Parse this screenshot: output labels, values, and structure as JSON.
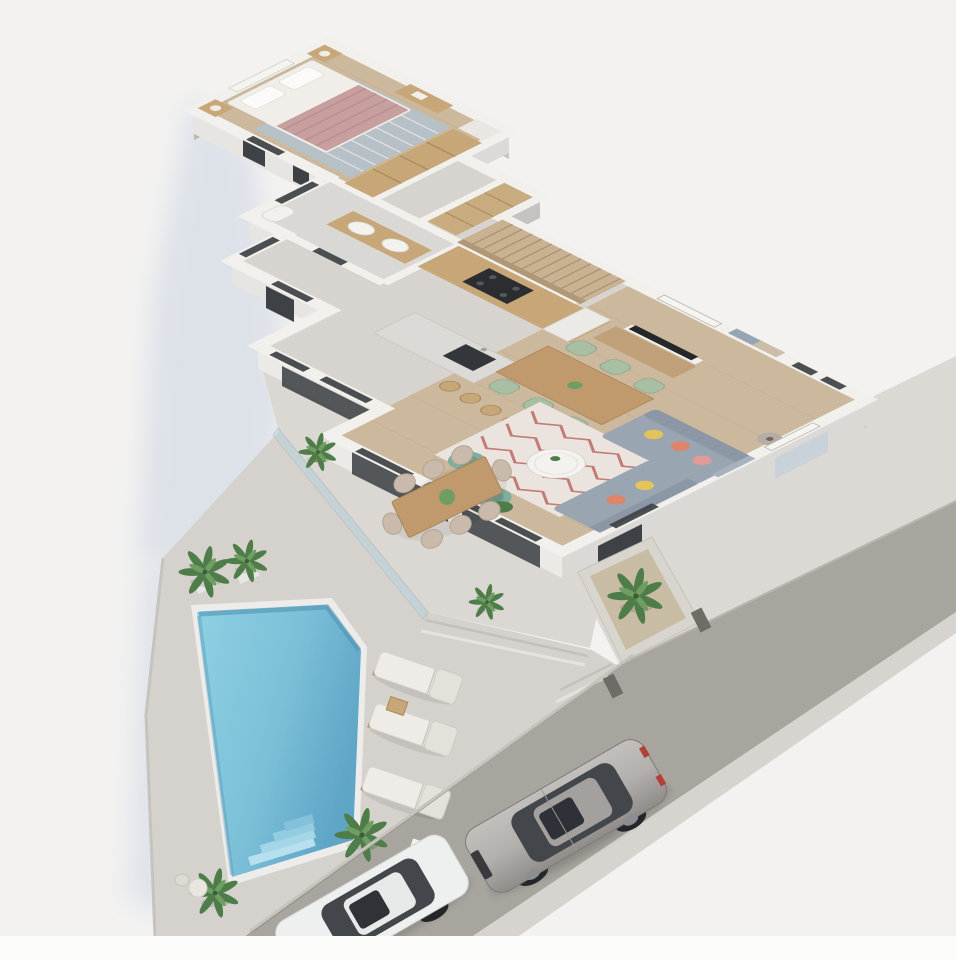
{
  "scene": {
    "description": "3D isometric cutaway render of a single-storey villa ground floor with pool terrace, outdoor dining, sun loungers and a street with two parked cars",
    "projection": "isometric 2:1 cutaway, walls cut at waist height",
    "no_visible_text": true
  },
  "house": {
    "rooms": [
      {
        "name": "bedroom",
        "floor": "wood",
        "furniture": [
          "double-bed",
          "pink-striped-blanket",
          "white-pillows",
          "nightstands-x2",
          "table-lamps",
          "blue-patterned-rug",
          "wood-wardrobe",
          "white-dresser",
          "window"
        ]
      },
      {
        "name": "bathroom",
        "floor": "gray-tile",
        "furniture": [
          "wood-double-sink-vanity",
          "toilet"
        ]
      },
      {
        "name": "hallway",
        "floor": "concrete",
        "furniture": [
          "closet-shelving"
        ]
      },
      {
        "name": "kitchen",
        "floor": "concrete",
        "furniture": [
          "wood-counter",
          "black-cooktop",
          "tall-white-cabinet",
          "island-with-dark-sink",
          "bar-stools-x4"
        ]
      },
      {
        "name": "dining-area",
        "floor": "wood",
        "furniture": [
          "wood-dining-table",
          "sage-green-chairs-x6",
          "wood-sideboard",
          "tv-panel",
          "wall-art"
        ]
      },
      {
        "name": "living-room",
        "floor": "wood",
        "furniture": [
          "l-shaped-gray-sofa",
          "pillows-yellow-coral-pink",
          "round-white-coffee-table",
          "zigzag-pattern-rug",
          "teal-armchairs-x2",
          "side-table",
          "floor-lamp",
          "plant"
        ]
      },
      {
        "name": "staircase",
        "material": "wood",
        "steps": 12
      }
    ]
  },
  "outdoor": {
    "upper_terrace": {
      "glass_balustrade": true,
      "outdoor_dining_table_seats": 8,
      "potted-plant": true,
      "steps_to_pool_terrace": 2
    },
    "pool_terrace": {
      "pool": true,
      "pool_corner_steps": true,
      "sun_loungers": 3,
      "lounger_side_table": true,
      "palm_trees": 5,
      "bistro_table_and_chair": true
    },
    "entry": {
      "planter_with_palm": true,
      "gate_posts": 2,
      "boundary_wall": true
    }
  },
  "street": {
    "surface": "gray asphalt running diagonally lower-left",
    "sidewalk": true,
    "cars": [
      {
        "type": "sedan",
        "color_name": "silver",
        "features": [
          "sunroof",
          "dark-glass",
          "chrome-grille"
        ]
      },
      {
        "type": "sedan",
        "color_name": "white",
        "features": [
          "sunroof",
          "dark-glass"
        ],
        "partially_visible": true
      }
    ]
  },
  "palette": {
    "bg": "#f3f2f1",
    "shadowBlue": "#ccd4e2",
    "bottomStrip": "#fcfcfb",
    "wallTop": "#f2f0ec",
    "wallInner": "#c4c3c1",
    "wallInnerDark": "#b8b7b5",
    "faceLight": "#e7e5e2",
    "faceMid": "#dcdad7",
    "faceDark": "#d4d2cf",
    "glassDark": "#3e4246",
    "windowLight": "#f4f4f1",
    "woodFloor": "#ccb89c",
    "woodLine": "#bfa888",
    "stairWood": "#c8b292",
    "stairLine": "#a8906f",
    "concrete": "#d7d4d0",
    "bathFloor": "#dad8d4",
    "cabinetWood": "#c7a678",
    "woodDark": "#a8875c",
    "islandTop": "#dcdad6",
    "applianceDark": "#2c2d30",
    "bedWhite": "#f1eee9",
    "blanketPink": "#c79f9e",
    "blanketLine": "#b78d8c",
    "rugBlue": "#b5c1cb",
    "rugLiving": "#ebe4de",
    "zigzag": "#b25a52",
    "sofaGray": "#9aa5b2",
    "sofaGrayDark": "#8b97a5",
    "pillowYellow": "#e3c35a",
    "pillowCoral": "#e08468",
    "pillowPink": "#e09b97",
    "sageChair": "#a9bfa4",
    "tealChair": "#7fae9f",
    "tealDark": "#6e9c8d",
    "tableWood": "#c09a6c",
    "outChair": "#c9baab",
    "loungerCushion": "#efece7",
    "loungerBack": "#e4e1db",
    "loungerWood": "#b5976e",
    "terraceUpper": "#dbd8d3",
    "terraceLower": "#d5d2cd",
    "stepLine": "#c4c1bc",
    "poolCoping": "#edecea",
    "poolLight": "#8ed0e3",
    "poolDark": "#5fa5c6",
    "poolEdge": "#4b8fae",
    "poolSteps": "#a5d6e7",
    "street": "#a8a49e",
    "curb": "#d7d4cf",
    "sidewalk": "#dcd9d4",
    "propWall": "#908d88",
    "postDark": "#6f6c68",
    "carSilver": "#b2afac",
    "carSilverDark": "#8f8c89",
    "carWhite": "#eef0ef",
    "carGlass": "#43474c",
    "roofSilver": "#a3a09d",
    "wheelDark": "#26262a",
    "tailRed": "#b33f3a",
    "palmGreen": "#4f7d49",
    "palmLight": "#6f9e62",
    "potTerracotta": "#b98f6a",
    "planterGravel": "#c9bca4",
    "balGlass": "#bcd8e4"
  }
}
